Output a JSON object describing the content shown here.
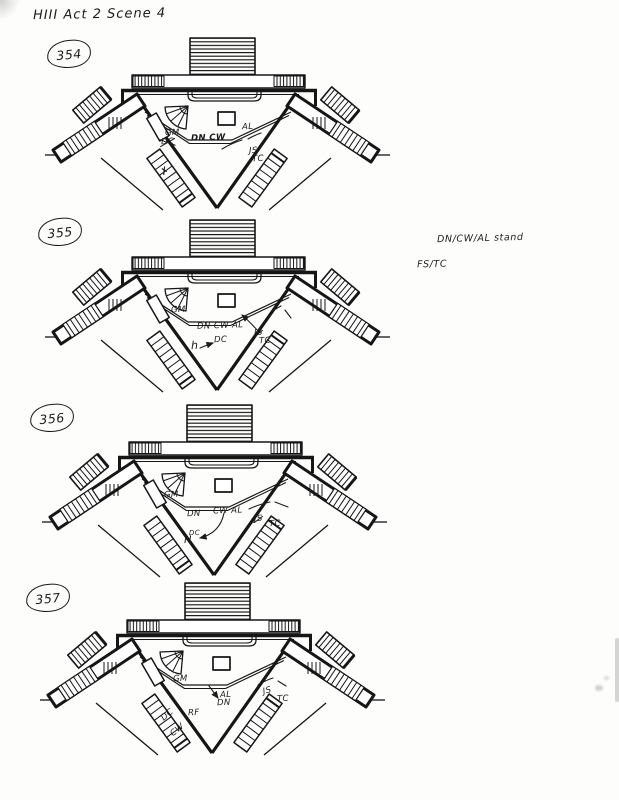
{
  "page": {
    "header": "HIII Act 2 Scene 4",
    "side_notes": [
      {
        "text": "DN/CW/AL stand",
        "x": 437,
        "y": 234
      },
      {
        "text": "FS/TC",
        "x": 417,
        "y": 260
      }
    ]
  },
  "figures": [
    {
      "number": "354",
      "pos": {
        "x": 45,
        "y": 30
      },
      "label_pos": {
        "x": 2,
        "y": 10
      },
      "annotations": [
        {
          "text": "GM",
          "x": 120,
          "y": 99
        },
        {
          "text": "DC",
          "x": 116,
          "y": 108,
          "cross": true
        },
        {
          "text": "DN CW",
          "x": 146,
          "y": 104,
          "bold": true
        },
        {
          "text": "AL",
          "x": 197,
          "y": 93
        },
        {
          "text": "JS",
          "x": 204,
          "y": 117
        },
        {
          "text": "TC",
          "x": 207,
          "y": 125
        },
        {
          "text": "✗",
          "x": 116,
          "y": 137,
          "rot": -30,
          "size": 10
        }
      ],
      "marks": [
        {
          "d": "M177,119 Q187,113 197,110"
        },
        {
          "d": "M203,109 Q210,105 216,103"
        }
      ]
    },
    {
      "number": "355",
      "pos": {
        "x": 45,
        "y": 212
      },
      "label_pos": {
        "x": -7,
        "y": 6
      },
      "annotations": [
        {
          "text": "GM",
          "x": 126,
          "y": 94
        },
        {
          "text": "DN CW AL",
          "x": 152,
          "y": 110
        },
        {
          "text": "DC",
          "x": 169,
          "y": 124
        },
        {
          "text": "h",
          "x": 146,
          "y": 128,
          "size": 11
        },
        {
          "text": "JS",
          "x": 209,
          "y": 117,
          "slash": true
        },
        {
          "text": "TC",
          "x": 214,
          "y": 125
        }
      ],
      "marks": [
        {
          "d": "M155,136 Q162,133 168,131",
          "head": true
        },
        {
          "d": "M214,120 Q204,109 197,103",
          "head": true
        },
        {
          "d": "M227,99 L236,94"
        },
        {
          "d": "M240,98 L246,106"
        }
      ]
    },
    {
      "number": "356",
      "pos": {
        "x": 42,
        "y": 397
      },
      "label_pos": {
        "x": -12,
        "y": 7
      },
      "annotations": [
        {
          "text": "GM",
          "x": 122,
          "y": 94
        },
        {
          "text": "DN",
          "x": 145,
          "y": 113
        },
        {
          "text": "CW AL",
          "x": 171,
          "y": 110
        },
        {
          "text": "JS",
          "x": 212,
          "y": 118,
          "slash": true
        },
        {
          "text": "TC",
          "x": 227,
          "y": 123
        },
        {
          "text": "DC",
          "x": 147,
          "y": 133,
          "size": 7
        },
        {
          "text": "H",
          "x": 142,
          "y": 139,
          "size": 10
        }
      ],
      "marks": [
        {
          "d": "M182,116 Q178,136 158,141",
          "head": true
        },
        {
          "d": "M207,112 Q218,107 228,105"
        },
        {
          "d": "M233,105 L246,110"
        }
      ]
    },
    {
      "number": "357",
      "pos": {
        "x": 40,
        "y": 575
      },
      "label_pos": {
        "x": -14,
        "y": 9
      },
      "annotations": [
        {
          "text": "GM",
          "x": 133,
          "y": 100
        },
        {
          "text": "AL",
          "x": 180,
          "y": 116
        },
        {
          "text": "DN",
          "x": 177,
          "y": 124
        },
        {
          "text": "JS",
          "x": 223,
          "y": 112,
          "rot": -14
        },
        {
          "text": "TC",
          "x": 237,
          "y": 120
        },
        {
          "text": "RF",
          "x": 148,
          "y": 134
        },
        {
          "text": "DC",
          "x": 121,
          "y": 136,
          "rot": -40
        },
        {
          "text": "CW",
          "x": 130,
          "y": 151,
          "rot": -40
        }
      ],
      "marks": [
        {
          "d": "M169,111 L178,123",
          "head": true
        },
        {
          "d": "M218,110 Q226,105 233,103"
        },
        {
          "d": "M238,106 L246,111"
        }
      ]
    }
  ]
}
